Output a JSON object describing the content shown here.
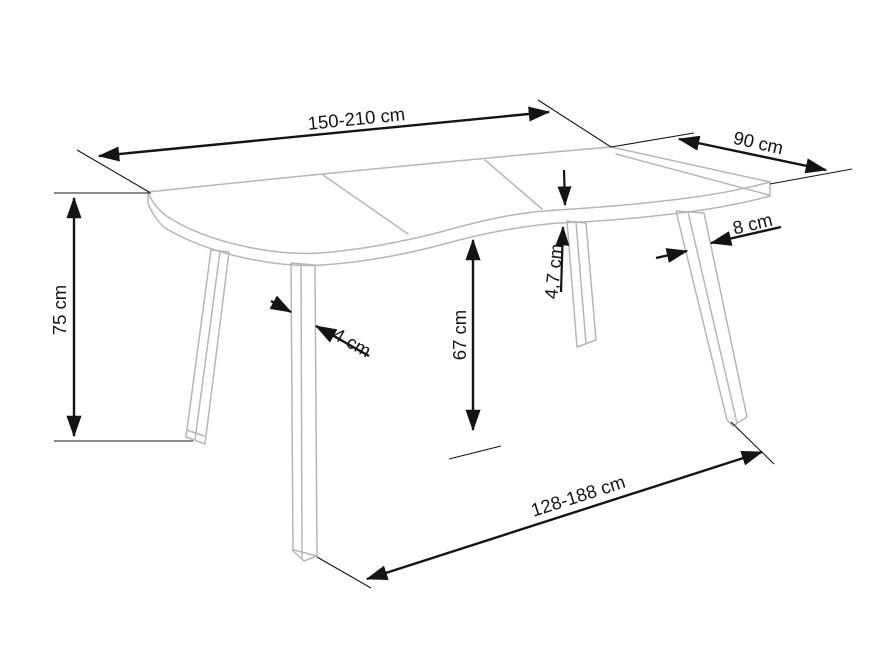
{
  "diagram": {
    "type": "furniture-dimension-drawing",
    "subject": "dining-table-with-wavy-extendable-top",
    "colors": {
      "background": "#ffffff",
      "furniture_outline": "#b6b6b6",
      "dimension_lines": "#141414",
      "label_text": "#141414"
    },
    "dimensions": {
      "top_length": {
        "label": "150-210 cm"
      },
      "top_depth": {
        "label": "90 cm"
      },
      "height": {
        "label": "75 cm"
      },
      "clearance": {
        "label": "67 cm"
      },
      "top_thickness": {
        "label": "4,7 cm"
      },
      "leg_width_top": {
        "label": "8 cm"
      },
      "leg_width_bottom": {
        "label": "4 cm"
      },
      "leg_span": {
        "label": "128-188 cm"
      }
    }
  }
}
